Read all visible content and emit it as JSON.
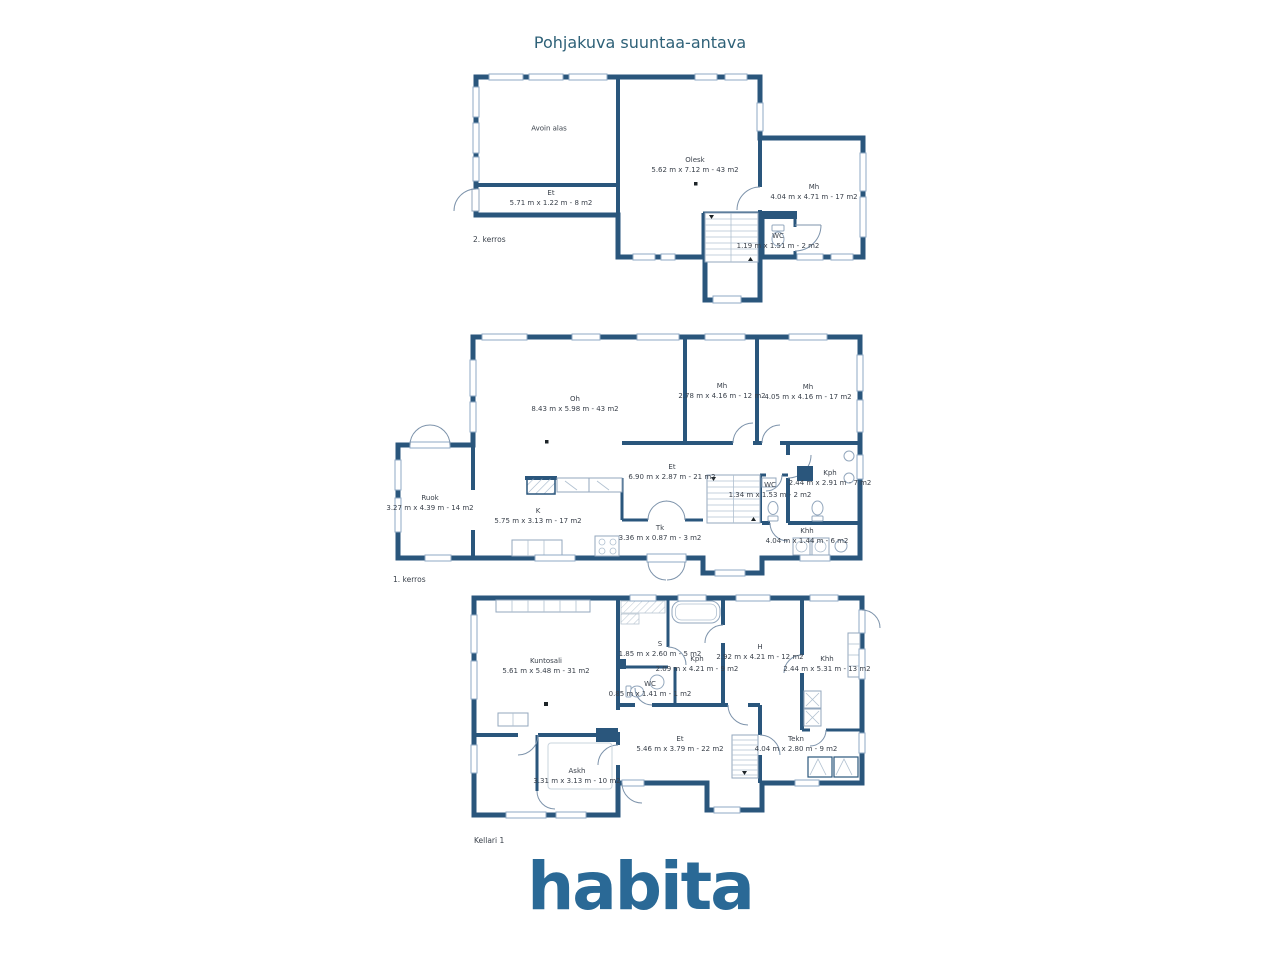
{
  "title": "Pohjakuva suuntaa-antava",
  "logo": "habita",
  "colors": {
    "wall": "#2a567c",
    "title_text": "#2e6178",
    "logo_text": "#2a6996",
    "label_text": "#3a414b",
    "window_stroke": "#8fa9c4",
    "door_stroke": "#7d93ab"
  },
  "icons": {
    "stairs-icon": "parallel tread lines",
    "toilet-icon": "ellipse bowl with tank",
    "bathtub-icon": "rounded rectangle tub",
    "door-icon": "quarter-circle swing arc",
    "window-icon": "double-line wall opening",
    "fireplace-icon": "diagonal hatched block",
    "washer-icon": "square with circle",
    "heater-icon": "square with zigzag"
  },
  "floors": [
    {
      "label": "2. kerros",
      "rooms": [
        {
          "name": "Avoin alas",
          "dims": ""
        },
        {
          "name": "Olesk",
          "dims": "5.62 m x 7.12 m - 43 m2"
        },
        {
          "name": "Et",
          "dims": "5.71 m x 1.22 m - 8 m2"
        },
        {
          "name": "Mh",
          "dims": "4.04 m x 4.71 m - 17 m2"
        },
        {
          "name": "WC",
          "dims": "1.19 m x 1.51 m - 2 m2"
        }
      ]
    },
    {
      "label": "1. kerros",
      "rooms": [
        {
          "name": "Oh",
          "dims": "8.43 m x 5.98 m - 43 m2"
        },
        {
          "name": "Mh",
          "dims": "2.78 m x 4.16 m - 12 m2"
        },
        {
          "name": "Mh",
          "dims": "4.05 m x 4.16 m - 17 m2"
        },
        {
          "name": "Et",
          "dims": "6.90 m x 2.87 m - 21 m2"
        },
        {
          "name": "Ruok",
          "dims": "3.27 m x 4.39 m - 14 m2"
        },
        {
          "name": "K",
          "dims": "5.75 m x 3.13 m - 17 m2"
        },
        {
          "name": "Tk",
          "dims": "3.36 m x 0.87 m - 3 m2"
        },
        {
          "name": "WC",
          "dims": "1.34 m x 1.53 m - 2 m2"
        },
        {
          "name": "Kph",
          "dims": "2.44 m x 2.91 m - 7 m2"
        },
        {
          "name": "Khh",
          "dims": "4.04 m x 1.44 m - 6 m2"
        }
      ]
    },
    {
      "label": "Kellari 1",
      "rooms": [
        {
          "name": "Kuntosali",
          "dims": "5.61 m x 5.48 m - 31 m2"
        },
        {
          "name": "S",
          "dims": "1.85 m x 2.60 m - 5 m2"
        },
        {
          "name": "Kph",
          "dims": "2.09 m x 4.21 m - 9 m2"
        },
        {
          "name": "H",
          "dims": "2.92 m x 4.21 m - 12 m2"
        },
        {
          "name": "Khh",
          "dims": "2.44 m x 5.31 m - 13 m2"
        },
        {
          "name": "WC",
          "dims": "0.85 m x 1.41 m - 1 m2"
        },
        {
          "name": "Et",
          "dims": "5.46 m x 3.79 m - 22 m2"
        },
        {
          "name": "Askh",
          "dims": "3.31 m x 3.13 m - 10 m2"
        },
        {
          "name": "Tekn",
          "dims": "4.04 m x 2.80 m - 9 m2"
        }
      ]
    }
  ]
}
